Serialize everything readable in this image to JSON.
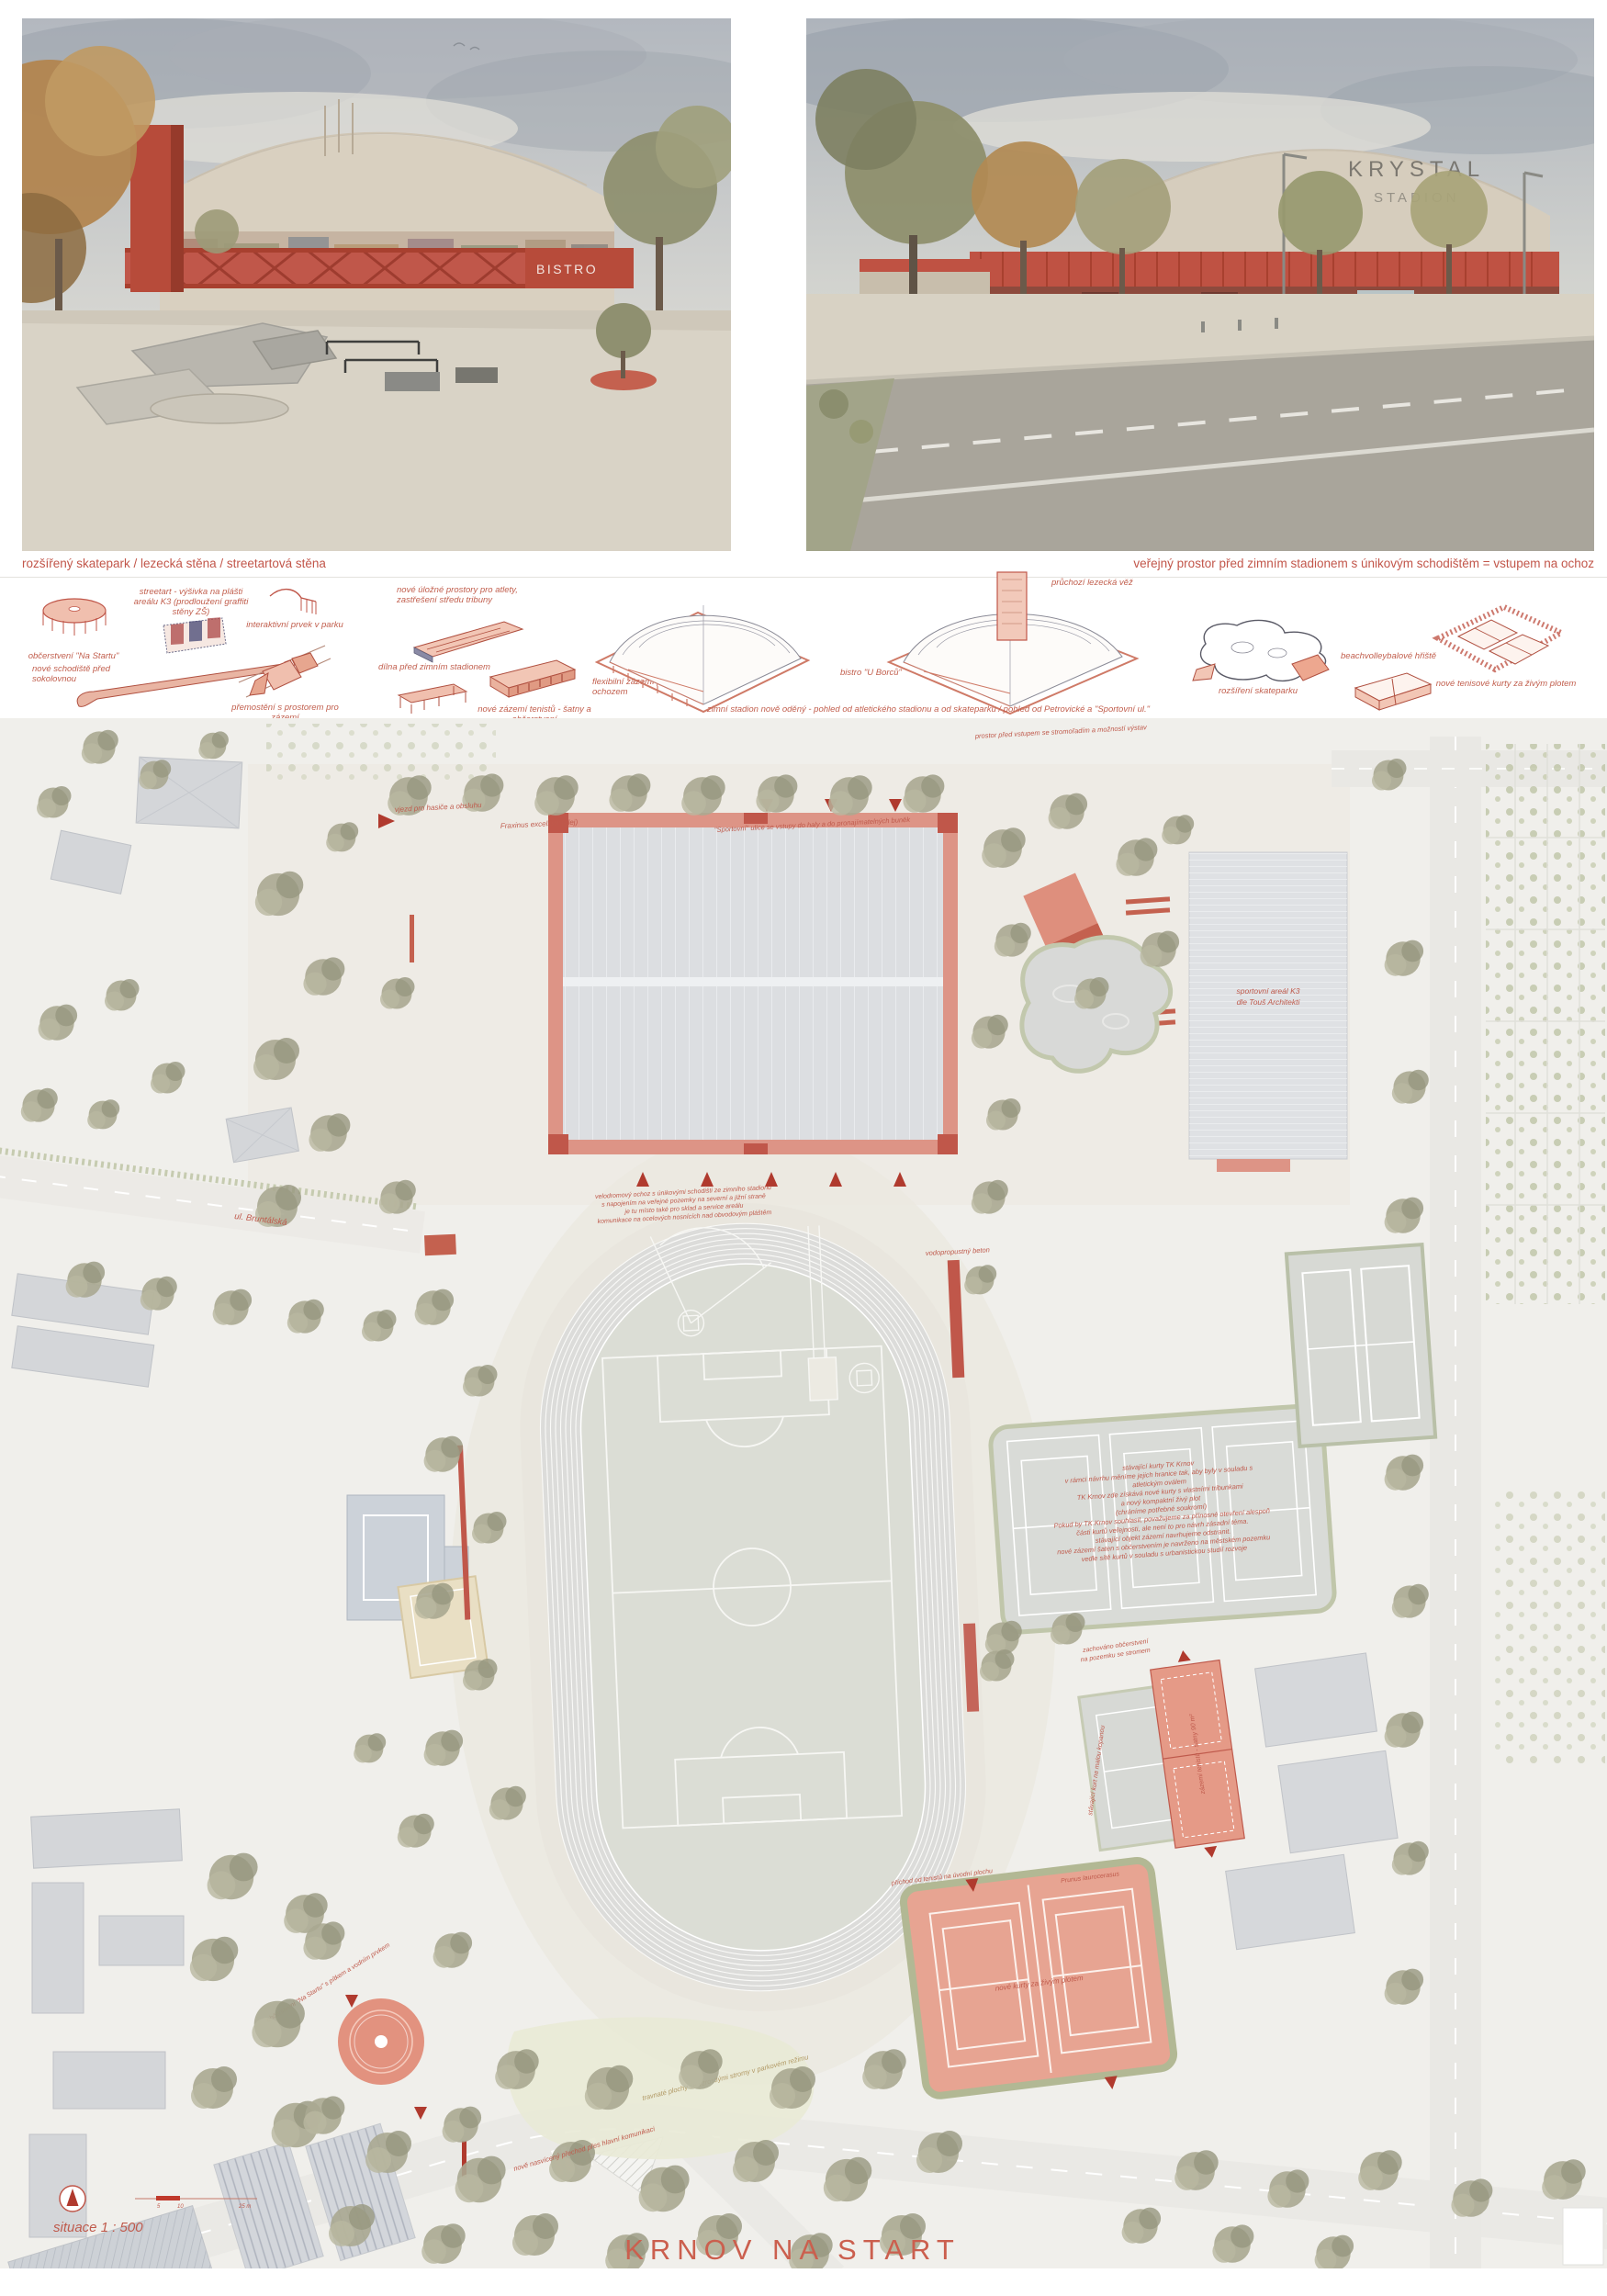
{
  "board": {
    "title": "KRNOV NA START"
  },
  "renders": {
    "left_caption": "rozšířený skatepark / lezecká stěna / streetartová stěna",
    "right_caption": "veřejný prostor před zimním stadionem s únikovým schodištěm = vstupem na ochoz",
    "left_signage": "BISTRO",
    "right_signage_line1": "KRYSTAL",
    "right_signage_line2": "STADION"
  },
  "diagrams": [
    {
      "label": "občerstvení \"Na Startu\""
    },
    {
      "label": "nové schodiště před sokolovnou"
    },
    {
      "label": "streetart - výšivka na plášti areálu K3 (prodloužení graffiti stěny ZŠ)"
    },
    {
      "label": "interaktivní prvek v parku"
    },
    {
      "label": "přemostění s prostorem pro zázemí"
    },
    {
      "label": "nové úložné prostory pro atlety, zastřešení středu tribuny"
    },
    {
      "label": "dílna před zimním stadionem"
    },
    {
      "label": "nové zázemí tenistů - šatny a občerstvení"
    },
    {
      "label": "flexibilní zázemí pod ochozem"
    },
    {
      "label": "zimní stadion nově oděný - pohled od atletického stadionu a od skateparku / pohled od Petrovické a \"Sportovní ul.\""
    },
    {
      "label": "bistro \"U Borců\""
    },
    {
      "label": "průchozí lezecká věž"
    },
    {
      "label": "rozšíření skateparku"
    },
    {
      "label": "beachvolleybalové hřiště"
    },
    {
      "label": "nové tenisové kurty za živým plotem"
    }
  ],
  "plan": {
    "labels": {
      "fire_access": "vjezd pro hasiče a obsluhu",
      "alley": "Fraxinus excelsior (alej)",
      "sport_street": "\"Sportovní\" ulice se vstupy do haly a do pronajímatelných buněk",
      "street_bruntalska": "ul. Bruntálská",
      "permeable": "vodopropustný beton",
      "k3_line1": "sportovní areál K3",
      "k3_line2": "dle Touš Architekti",
      "forecourt": "prostor před vstupem se stromořadím a možností výstav",
      "new_courts": "nové kurty za živým plotem",
      "hedge_species": "Prunus laurocerasus",
      "tennis_access": "příchod od tenistů na úvodní plochu",
      "kiosk": "občerstvení \"Na Startu\" s pítkem a vodním prvkem",
      "park_lawn": "travnaté plochy se vzrostlými stromy v parkovém režimu",
      "kept_kiosk_1": "zachováno občerstvení",
      "kept_kiosk_2": "na pozemku se stromem",
      "tennis_facility": "zázemí tenistů - šatny 90 m²",
      "crossing": "nově nasvícený přechod přes hlavní komunikaci",
      "small_pitch": "stávající kurt na malou kopanou"
    },
    "ochoz_note": [
      "velodromový ochoz s únikovými schodišti ze zimního stadionu",
      "s napojením na veřejné pozemky na severní a jižní straně",
      "je tu místo také pro sklad a service areálu",
      "komunikace na ocelových nosnících nad obvodovým pláštěm"
    ],
    "tk_note": [
      "stávající kurty TK Krnov",
      "v rámci návrhu měníme jejich hranice tak, aby byly v souladu s",
      "atletickým oválem",
      "TK Krnov zde získává nové kurty s vlastními tribunkami",
      "a nový kompaktní živý plot",
      "(chráníme potřebné soukromí)",
      "Pokud by TK Krnov souhlasil, považujeme za přínosné otevření alespoň",
      "části kurtů veřejnosti, ale není to pro návrh zásadní téma.",
      "stávající objekt zázemí navrhujeme odstranit.",
      "nové zázemí šaten s občerstvením je navrženo na městském pozemku",
      "vedle sítě kurtů v souladu s urbanistickou studií rozvoje"
    ],
    "scale_label": "situace  1 : 500",
    "scale_ticks": [
      "5",
      "10",
      "25 m"
    ]
  }
}
